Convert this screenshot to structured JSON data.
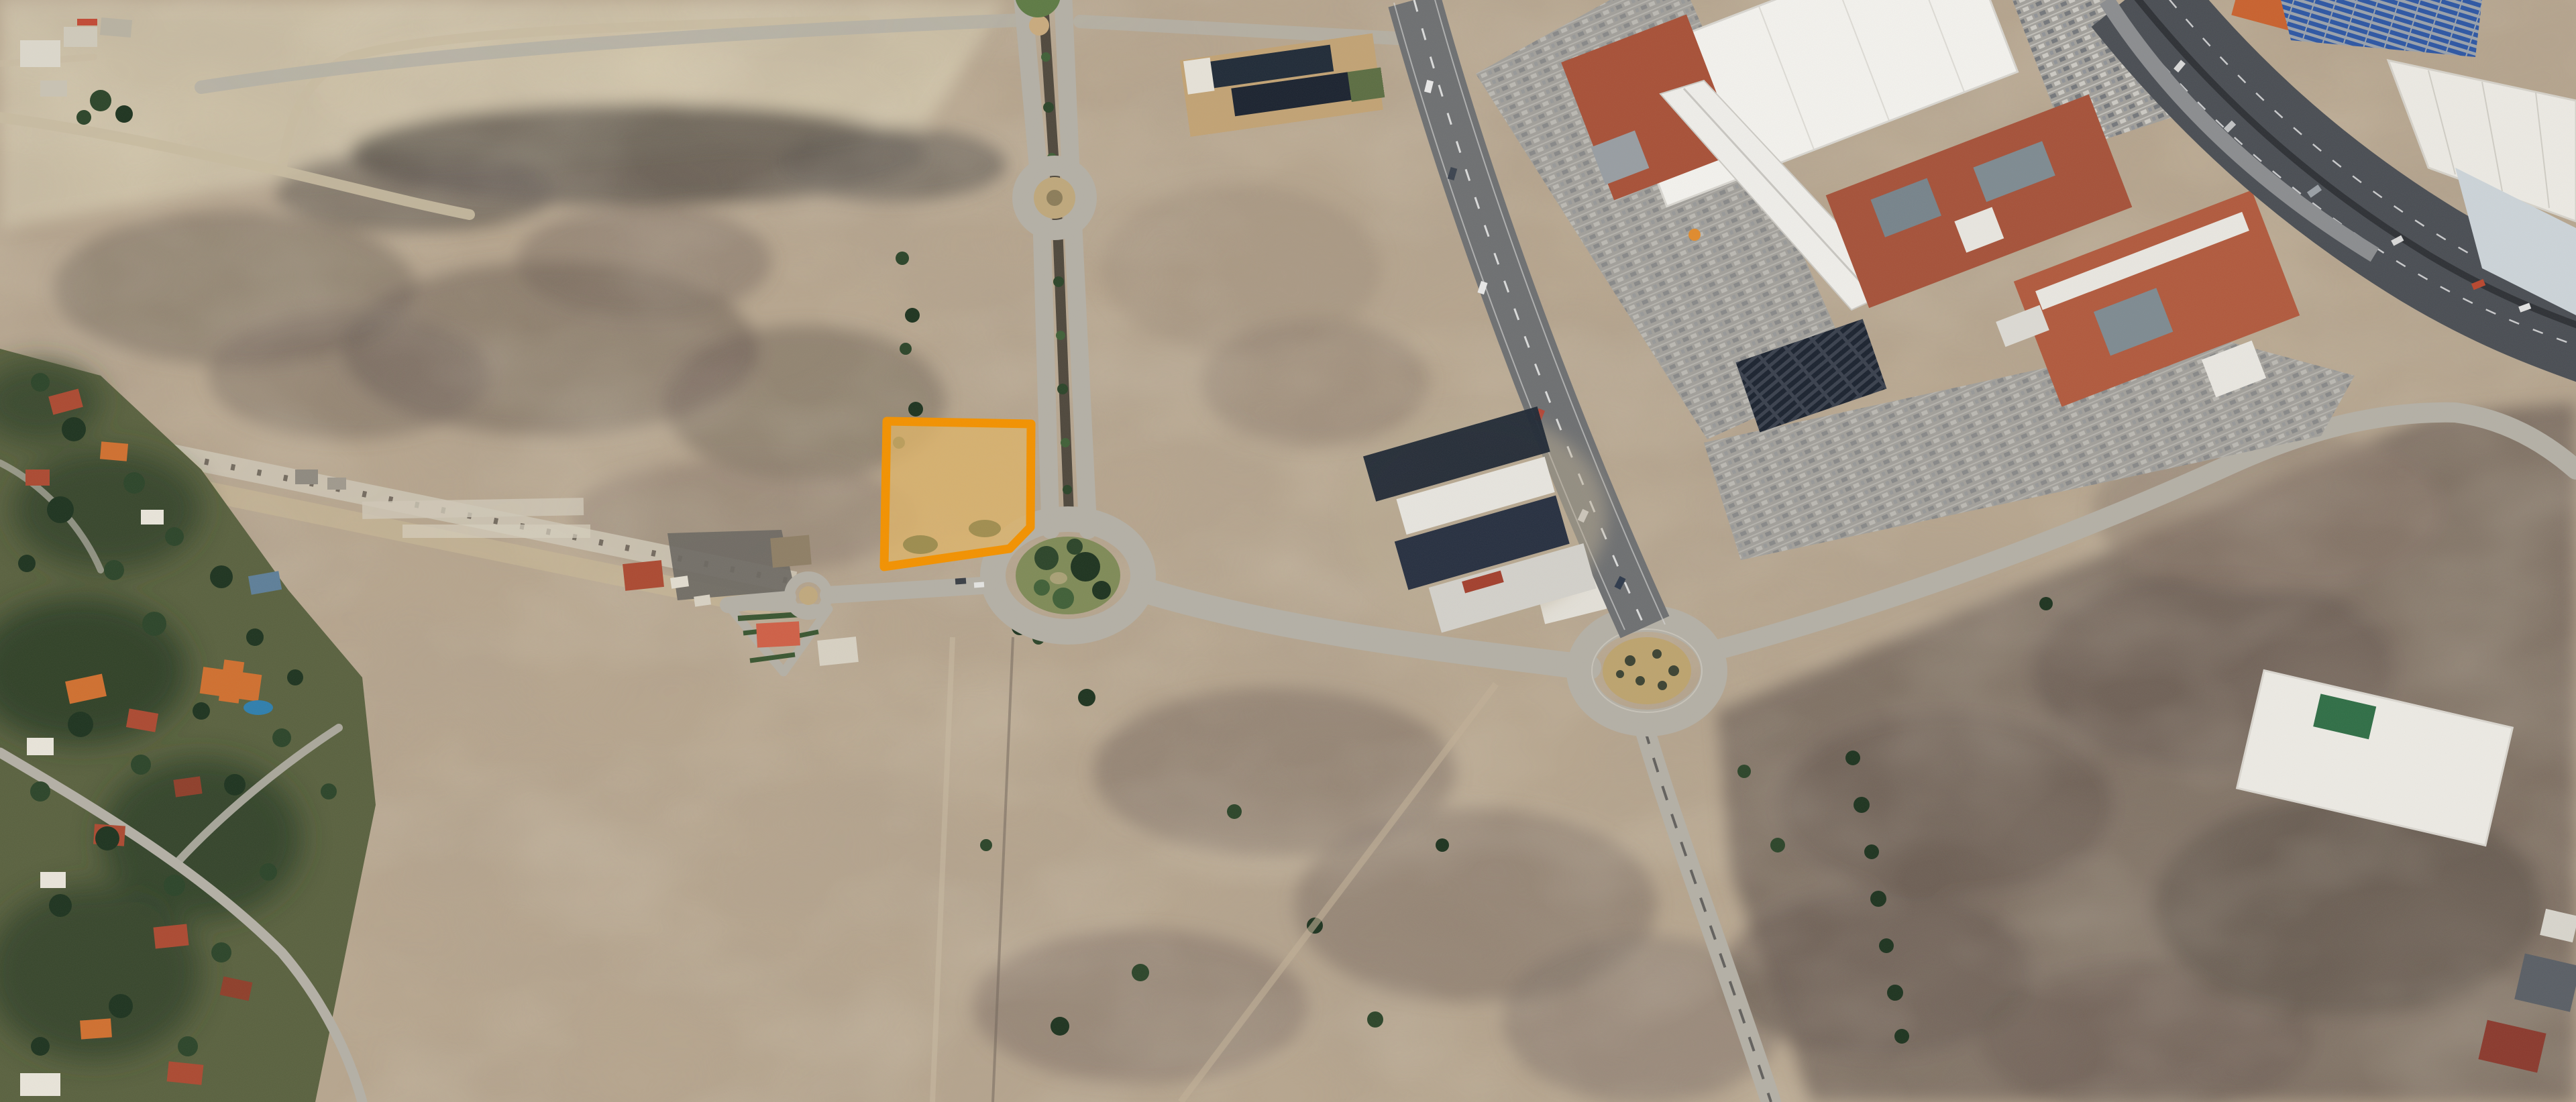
{
  "app": {
    "name": "aerial-satellite-view",
    "description": "Oblique aerial satellite photograph of a suburban development zone with one vacant land parcel highlighted by an orange outline",
    "visible_text": []
  },
  "colors": {
    "ground": "#b7a68f",
    "ground_light": "#d2c6ab",
    "scrub": "#6e6158",
    "scrub_dark": "#565049",
    "scrub_purple": "#7b6c63",
    "road": "#b4b0a6",
    "road_dirt": "#c8bba1",
    "avenue": "#6e7072",
    "median": "#4f483d",
    "highway": "#4a4e54",
    "island_green": "#7f8b58",
    "island_dirt": "#bda46f",
    "tree": "#2c452a",
    "tree_dark": "#1e3420",
    "tree_light": "#406038",
    "residential_green": "#5a6240",
    "roof_red": "#ac4a32",
    "roof_orange": "#d07030",
    "roof_white": "#e9e5da",
    "roof_brown": "#8f3f2b",
    "roof_blue": "#5e7f99",
    "pool_blue": "#2f7fae",
    "mall_white": "#f3f2ee",
    "mall_red": "#a85138",
    "mall_gray": "#989ea3",
    "panel_dark": "#1b2330",
    "panel_blue": "#2d57a4",
    "parking": "#a2a09b",
    "warehouse_white": "#eceae4",
    "warehouse_blue": "#ccd4d9",
    "grass_green": "#2f6e46",
    "dirt_pad": "#6d6963",
    "parcel_stroke": "#f39200",
    "parcel_fill": "#dfb469"
  },
  "scene": {
    "type": "satellite-aerial-photo",
    "highlighted_parcel": {
      "present": true,
      "outline_color_name": "orange",
      "shape": "polygon",
      "state": "vacant dirt lot beside boulevard and roundabout"
    },
    "features": [
      {
        "name": "highlighted-parcel",
        "kind": "selected land parcel outlined in orange"
      },
      {
        "name": "main-avenue",
        "kind": "north-south divided boulevard with planted median"
      },
      {
        "name": "small-roundabout",
        "kind": "small traffic circle on boulevard"
      },
      {
        "name": "large-green-roundabout",
        "kind": "landscaped roundabout with trees"
      },
      {
        "name": "east-roundabout",
        "kind": "large roundabout with dirt island"
      },
      {
        "name": "shopping-mall-complex",
        "kind": "big-box mall with white and terracotta roofs"
      },
      {
        "name": "mall-parking-lots",
        "kind": "striped parking areas with cars"
      },
      {
        "name": "northeast-avenue",
        "kind": "wide avenue with traffic along mall"
      },
      {
        "name": "highway-corridor",
        "kind": "multi-lane highway crossing top right corner"
      },
      {
        "name": "industrial-warehouses",
        "kind": "warehouses and blue panel arrays beyond highway"
      },
      {
        "name": "residential-neighborhood",
        "kind": "tree-covered neighborhood with tiled roofs and pool"
      },
      {
        "name": "vacant-scrubland",
        "kind": "bare dirt and scrub parcels under development"
      },
      {
        "name": "school-campus",
        "kind": "tan building complex with dark roofs"
      },
      {
        "name": "construction-site",
        "kind": "buildings under construction with dark shells"
      }
    ]
  }
}
